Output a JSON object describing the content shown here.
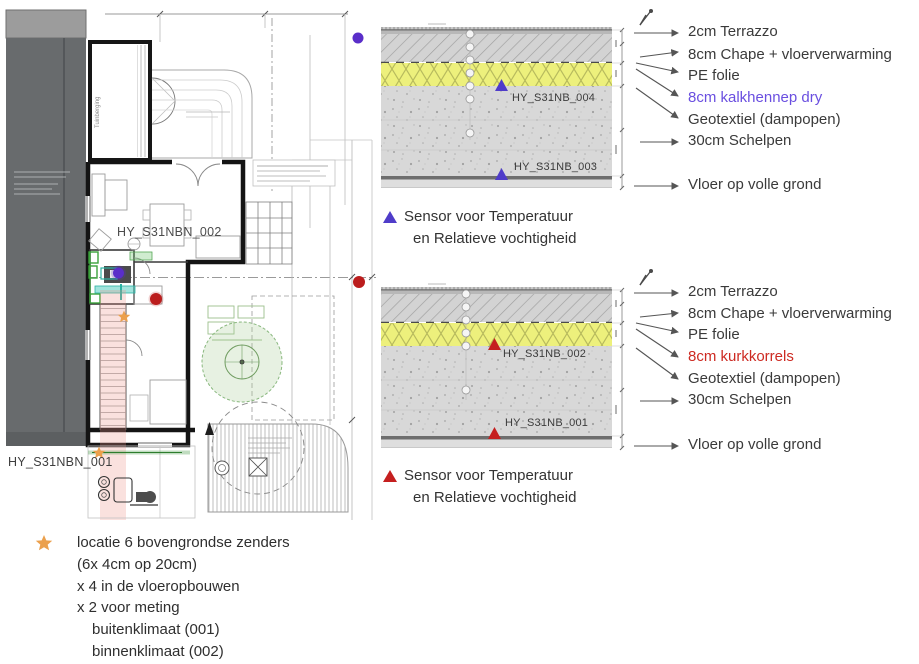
{
  "colors": {
    "purple_marker": "#5a2ec9",
    "purple_triangle": "#4f3cc9",
    "purple_highlight_text": "#6a4fe0",
    "red_marker": "#bb1d1d",
    "red_triangle": "#c51f1f",
    "red_highlight_text": "#cd2a22",
    "orange_star": "#eba04d",
    "insulation_yellow": "#edf07c"
  },
  "plan": {
    "room_label_upper": "HY_S31NBN_002",
    "room_label_lower": "HY_S31NBN_001",
    "shed_label": "Tuinberging"
  },
  "sections": [
    {
      "layers": [
        "2cm Terrazzo",
        "8cm Chape + vloerverwarming",
        "PE folie",
        "8cm kalkhennep dry",
        "Geotextiel (dampopen)",
        "30cm Schelpen",
        "Vloer op volle grond"
      ],
      "sensors": [
        "HY_S31NB_004",
        "HY_S31NB_003"
      ],
      "legend_line1": "Sensor voor Temperatuur",
      "legend_line2": "en Relatieve vochtigheid"
    },
    {
      "layers": [
        "2cm Terrazzo",
        "8cm Chape + vloerverwarming",
        "PE folie",
        "8cm kurkkorrels",
        "Geotextiel (dampopen)",
        "30cm Schelpen",
        "Vloer op volle grond"
      ],
      "sensors": [
        "HY_S31NB_002",
        "HY_S31NB_001"
      ],
      "legend_line1": "Sensor voor Temperatuur",
      "legend_line2": "en Relatieve vochtigheid"
    }
  ],
  "transmitters_legend": {
    "lines": [
      "locatie 6 bovengrondse zenders",
      "(6x 4cm op 20cm)",
      "x 4 in de vloeropbouwen",
      "x 2 voor meting",
      "buitenklimaat (001)",
      "binnenklimaat (002)"
    ]
  }
}
